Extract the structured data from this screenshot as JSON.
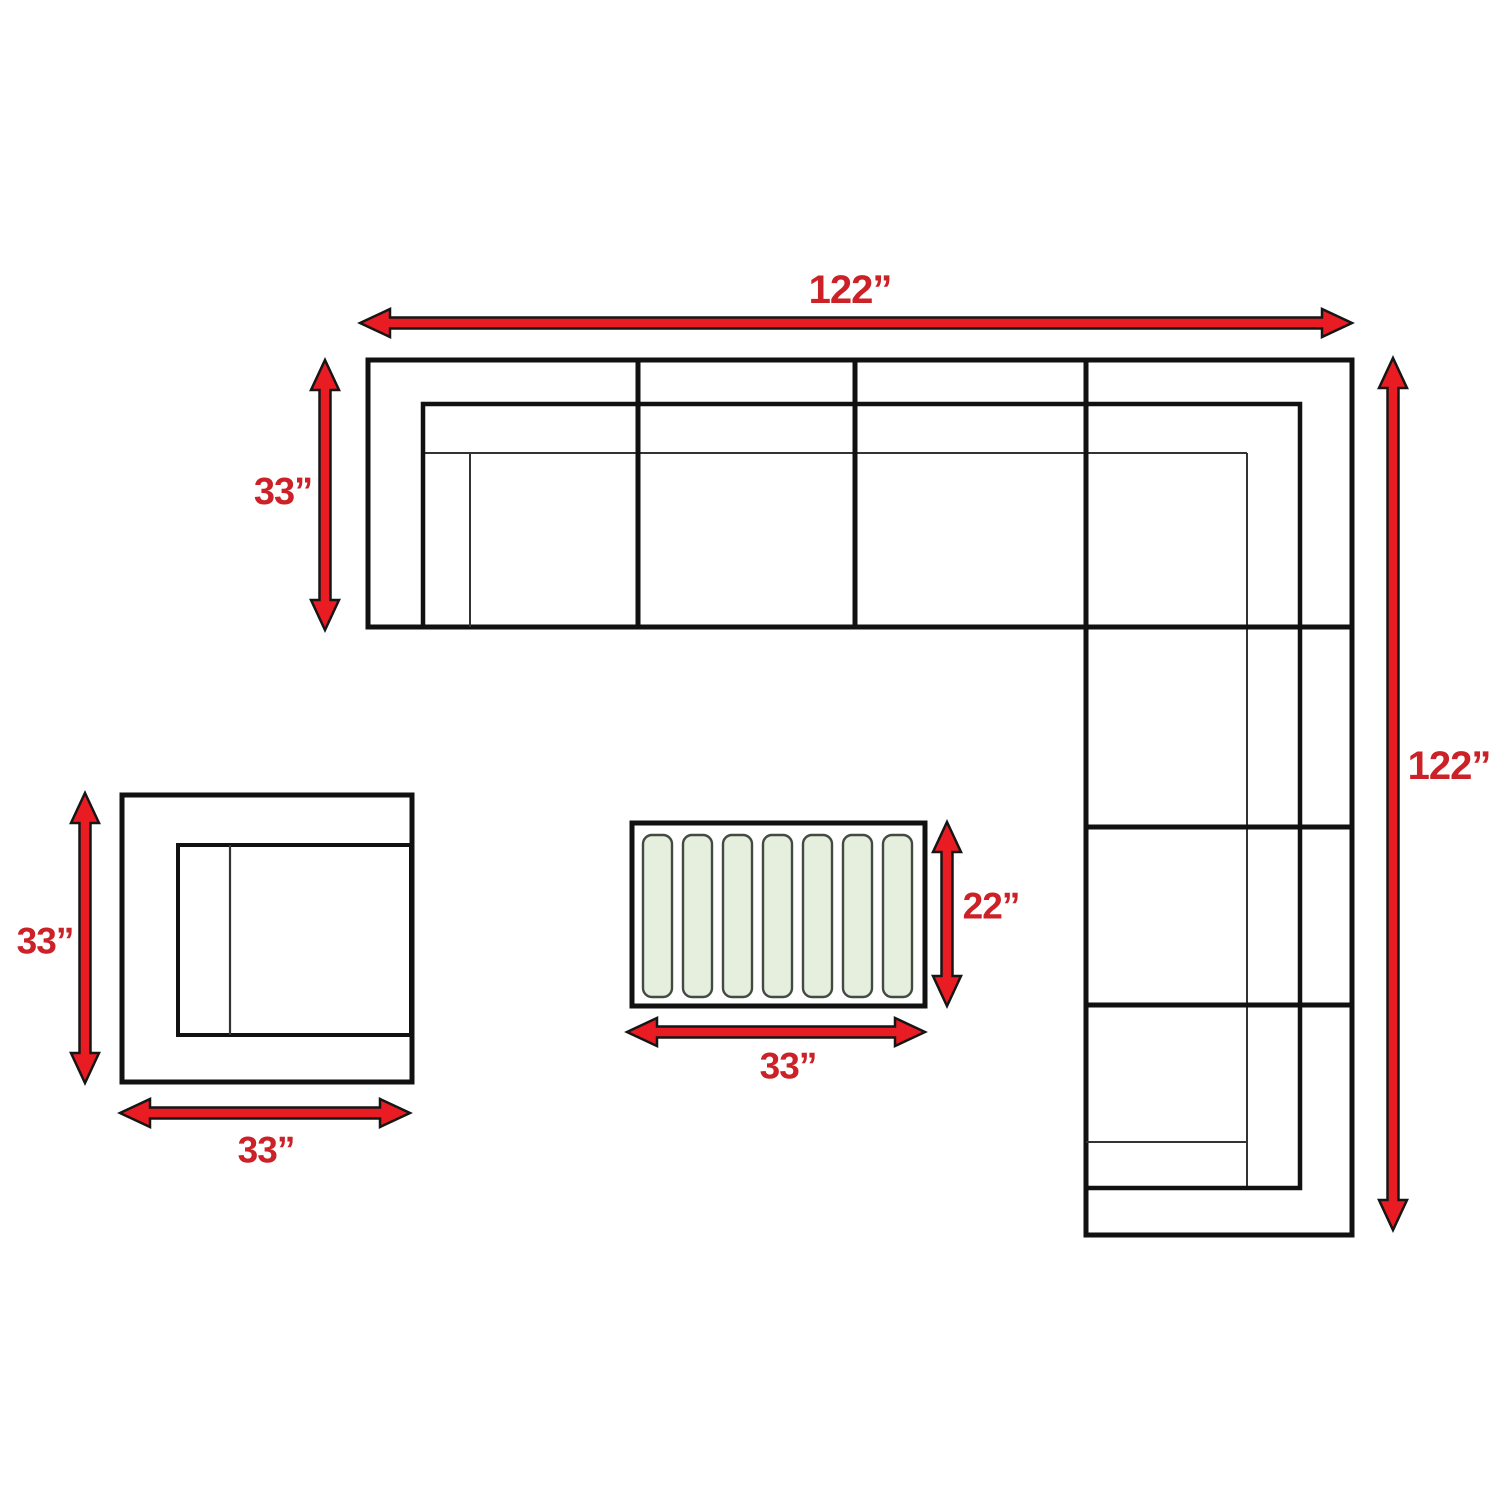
{
  "title": "Sectional sofa set dimension diagram",
  "canvas": {
    "width": 1500,
    "height": 1500,
    "background": "#ffffff"
  },
  "colors": {
    "arrow_fill": "#ea1c23",
    "arrow_outline": "#161616",
    "label_red": "#cb2127",
    "line_thick": "#111111",
    "line_thin": "#333333",
    "shape_fill": "#ffffff",
    "slat_fill": "#e6eedd",
    "slat_border": "#424a42"
  },
  "sofa": {
    "name": "sectional-sofa-plan",
    "outline_points": [
      [
        368,
        360
      ],
      [
        1352,
        360
      ],
      [
        1352,
        1235
      ],
      [
        1086,
        1235
      ],
      [
        1086,
        627
      ],
      [
        368,
        627
      ]
    ],
    "divider_lines": [
      [
        638,
        360,
        638,
        627
      ],
      [
        855,
        360,
        855,
        627
      ],
      [
        1086,
        360,
        1086,
        627
      ],
      [
        1086,
        627,
        1352,
        627
      ],
      [
        1086,
        827,
        1352,
        827
      ],
      [
        1086,
        1005,
        1352,
        1005
      ]
    ],
    "inner_polyline": [
      [
        423,
        627
      ],
      [
        423,
        404
      ],
      [
        1300,
        404
      ],
      [
        1300,
        1188
      ],
      [
        1086,
        1188
      ]
    ],
    "thin_lines": [
      [
        423,
        453,
        1247,
        453
      ],
      [
        470,
        453,
        470,
        627
      ],
      [
        1247,
        453,
        1247,
        1188
      ],
      [
        1086,
        1142,
        1247,
        1142
      ]
    ],
    "thick_width": 5,
    "inner_width": 4.5,
    "thin_width": 2
  },
  "chair": {
    "name": "armchair-plan",
    "outer_rect": [
      122,
      795,
      290,
      287
    ],
    "inner_rect": [
      178,
      845,
      233,
      190
    ],
    "inner_line": [
      230,
      845,
      230,
      1035
    ],
    "outer_width": 5,
    "inner_width": 4,
    "line_width": 2.2
  },
  "table": {
    "name": "coffee-table-plan",
    "outer_rect": [
      632,
      823,
      293,
      183
    ],
    "outer_width": 5,
    "slats": {
      "xs": [
        643,
        683,
        723,
        763,
        803,
        843,
        883
      ],
      "y": 835,
      "width": 29,
      "height": 162,
      "rx": 9,
      "border_width": 2.4
    }
  },
  "arrow_style": {
    "shaft_half": 5.5,
    "head_length": 30,
    "head_half": 14,
    "outline_width": 2.5
  },
  "dimensions": [
    {
      "id": "sofa-width",
      "label": "122”",
      "dir": "h",
      "from": 360,
      "to": 1352,
      "at": 323,
      "label_x": 850,
      "label_y": 290,
      "size": 40
    },
    {
      "id": "sofa-depth",
      "label": "33”",
      "dir": "v",
      "from": 360,
      "to": 630,
      "at": 325,
      "label_x": 283,
      "label_y": 492,
      "size": 38
    },
    {
      "id": "sofa-length",
      "label": "122”",
      "dir": "v",
      "from": 358,
      "to": 1230,
      "at": 1393,
      "label_x": 1449,
      "label_y": 766,
      "size": 40
    },
    {
      "id": "chair-depth",
      "label": "33”",
      "dir": "v",
      "from": 793,
      "to": 1083,
      "at": 85,
      "label_x": 45,
      "label_y": 941,
      "size": 37
    },
    {
      "id": "chair-width",
      "label": "33”",
      "dir": "h",
      "from": 120,
      "to": 410,
      "at": 1113,
      "label_x": 266,
      "label_y": 1150,
      "size": 37
    },
    {
      "id": "table-depth",
      "label": "22”",
      "dir": "v",
      "from": 822,
      "to": 1006,
      "at": 947,
      "label_x": 991,
      "label_y": 906,
      "size": 37
    },
    {
      "id": "table-width",
      "label": "33”",
      "dir": "h",
      "from": 627,
      "to": 925,
      "at": 1032,
      "label_x": 788,
      "label_y": 1066,
      "size": 37
    }
  ]
}
